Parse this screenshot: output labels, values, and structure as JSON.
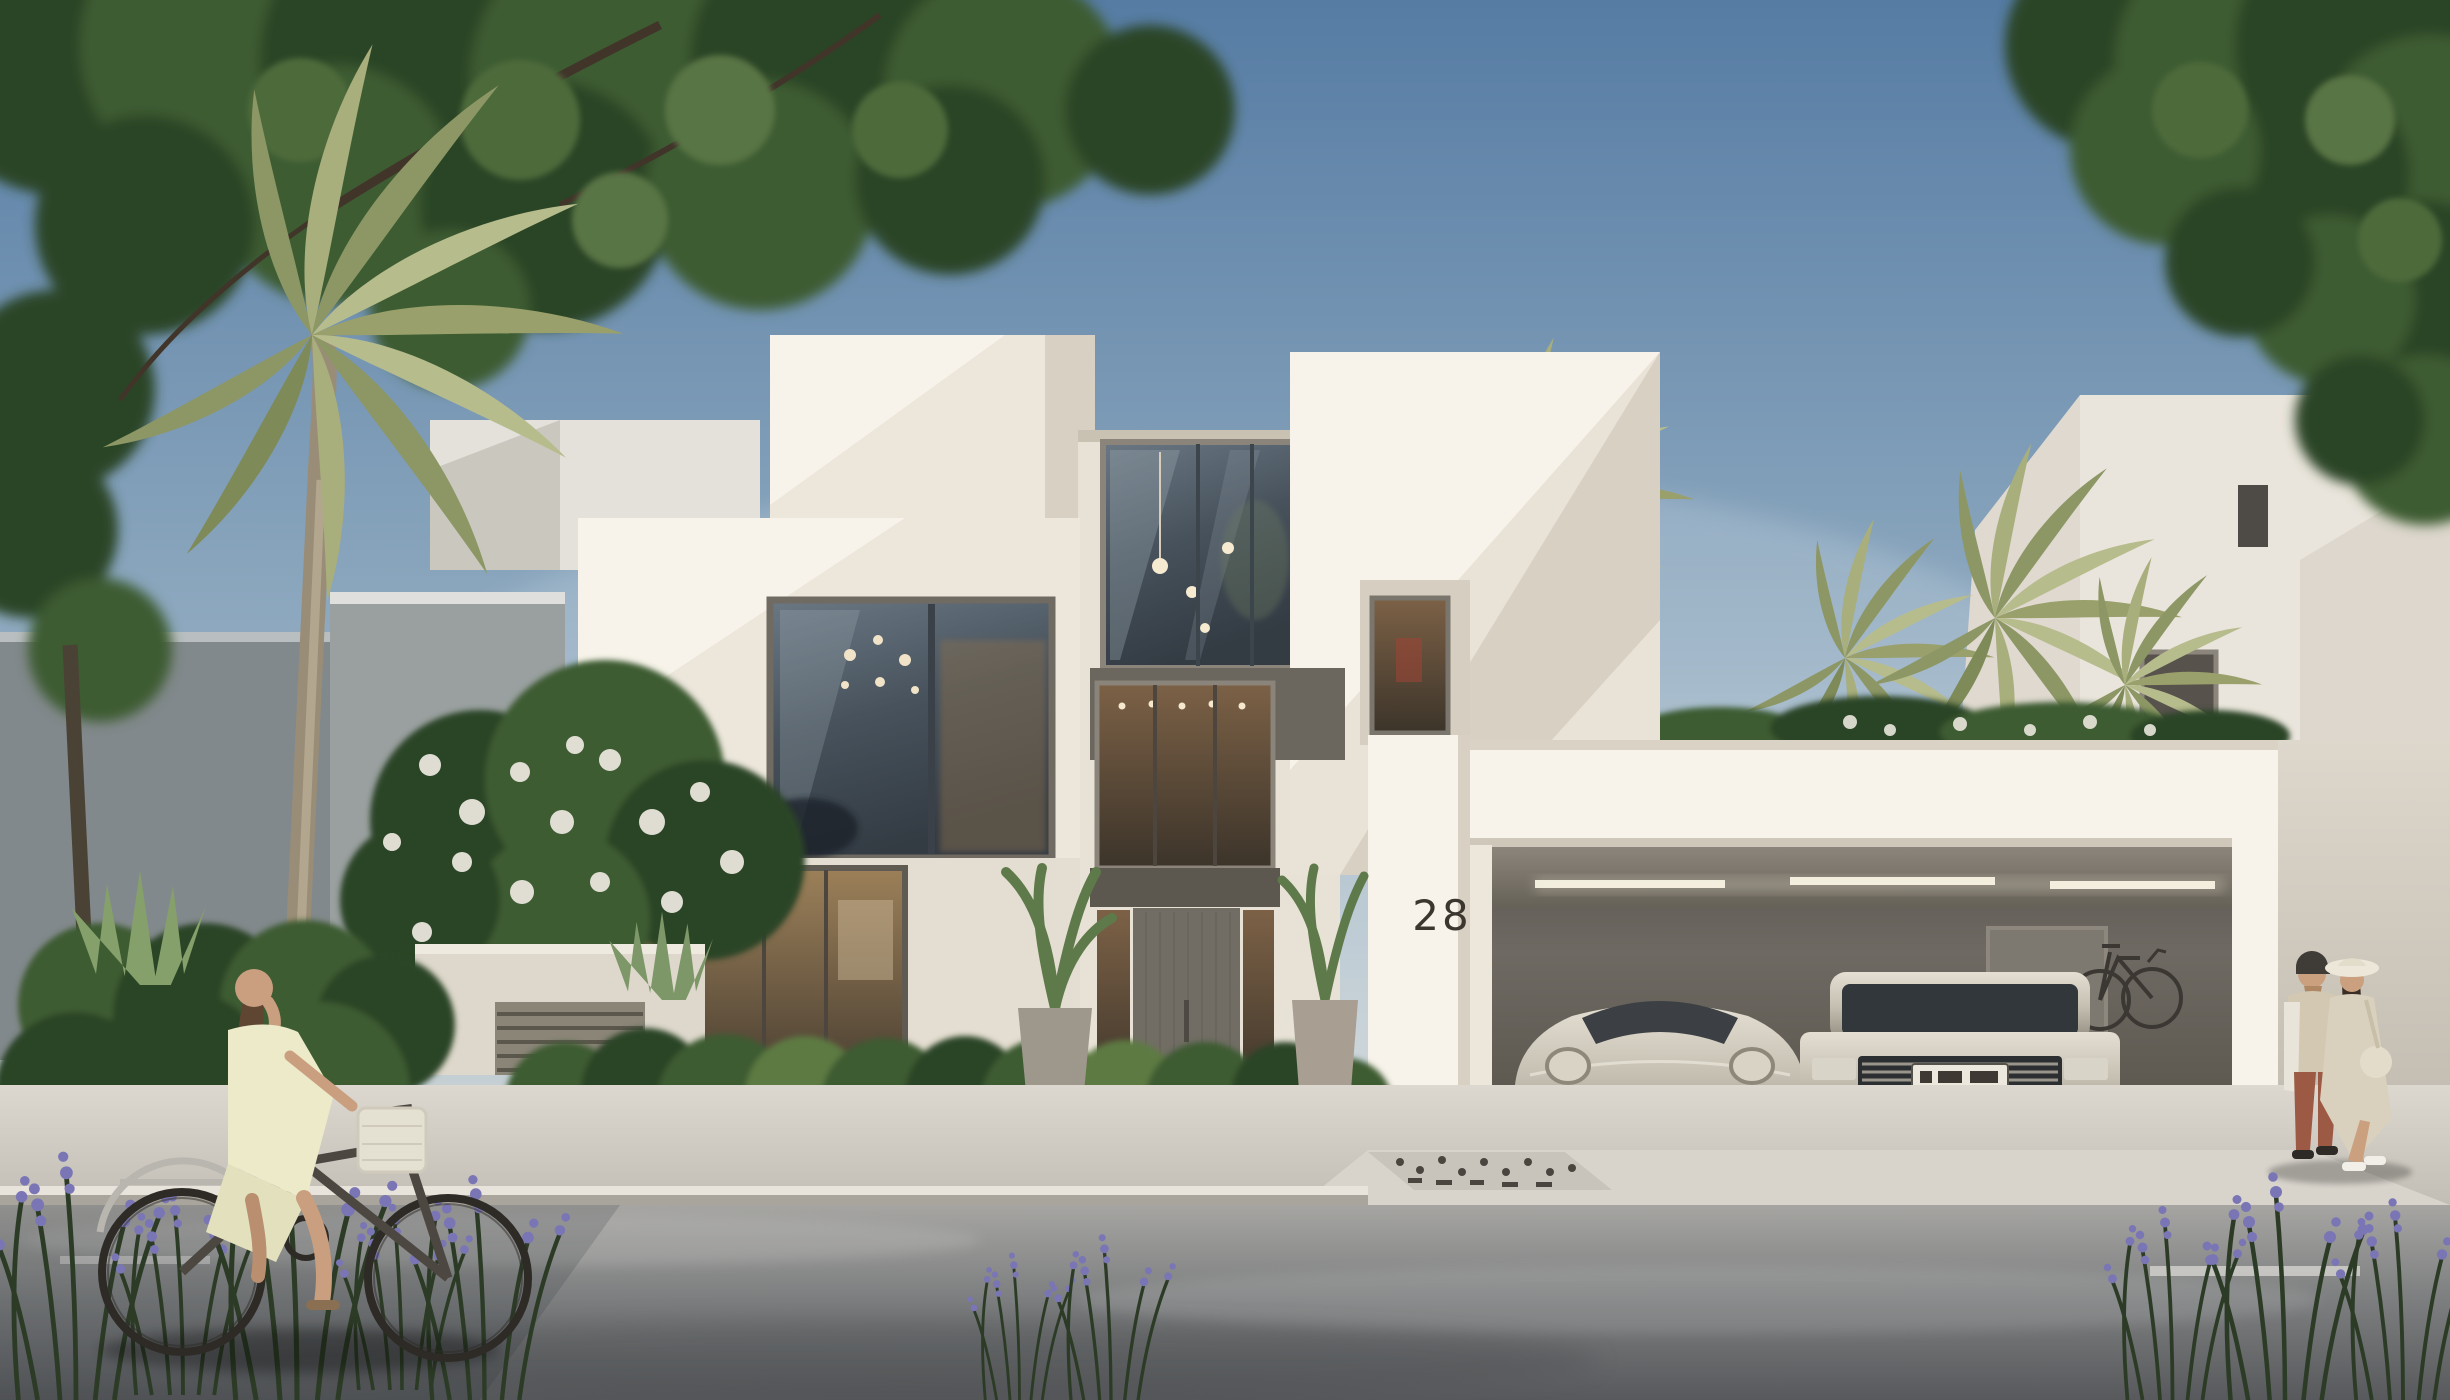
{
  "scene": {
    "house_number": "28"
  },
  "colors": {
    "sky-top": "#567ca4",
    "sky-mid": "#8ea9bf",
    "sky-horizon": "#e4e2d8",
    "villa-cream": "#ece6db",
    "villa-bright": "#f7f3ea",
    "villa-shadow": "#d8d0c3",
    "frame-dark": "#5f5a52",
    "glass-dark": "#47525c",
    "glass-warm": "#7c6146",
    "garage-wall": "#6e6962",
    "garage-ceiling": "#8d867c",
    "car-silver": "#c5bfb2",
    "sidewalk": "#d6d2ca",
    "road-top": "#a6a5a2",
    "road-bottom": "#57595c",
    "foliage-dark": "#2c4427",
    "foliage-mid": "#3c5c33",
    "foliage-light": "#5d7a42",
    "palm-olive": "#9aa06b",
    "flower-white": "#e9e6dc",
    "flower-purple": "#7a76b5",
    "number-color": "#3b362f"
  }
}
